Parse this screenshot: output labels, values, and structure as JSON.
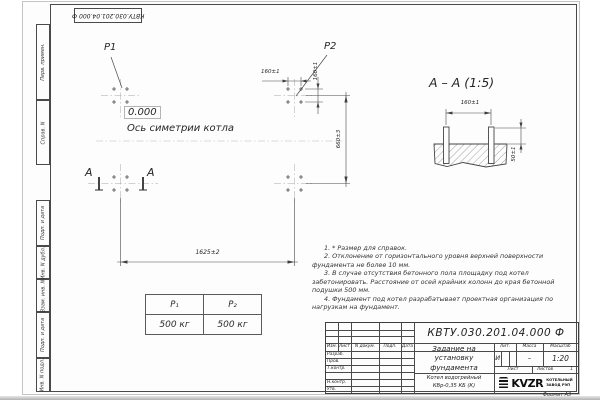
{
  "side_labels": [
    "Перв. примен.",
    "Справ. N",
    "Подп. и дата",
    "Инв. N дубл.",
    "Взам. инв. N",
    "Подп. и дата",
    "Инв. N подл."
  ],
  "plan": {
    "p1": "P1",
    "p2": "P2",
    "elevation": "0.000",
    "axis_label": "Ось симетрии котла",
    "section_letter_left": "А",
    "section_letter_right": "А",
    "dims": {
      "top_spacing": "160±1",
      "side_spacing": "160±1",
      "height": "660±3",
      "width": "1625±2"
    }
  },
  "section": {
    "title": "А – А (1:5)",
    "dims": {
      "bolt_spacing": "160±1",
      "protrusion": "50±1"
    }
  },
  "load_table": {
    "headers": [
      "Р₁",
      "Р₂"
    ],
    "values": [
      "500 кг",
      "500 кг"
    ]
  },
  "notes": [
    "1. * Размер для справок.",
    "2. Отклонение от горизонтального уровня верхней поверхности фундамента не более 10 мм.",
    "3. В случае отсутствия бетонного пола площадку под котел забетонировать. Расстояние от осей крайних колонн до края бетонной подушки 500 мм.",
    "4. Фундамент под котел разрабатывает проектная организация по нагрузкам на фундамент."
  ],
  "title_block": {
    "designation": "КВТУ.030.201.04.000  Ф",
    "title_lines": [
      "Задание на",
      "установку",
      "фундамента"
    ],
    "product_lines": [
      "Котел водогрейный",
      "КВр-0,35  КБ  (К)"
    ],
    "rev_headers": [
      "Изм.",
      "Лист",
      "N докум.",
      "Подп.",
      "Дата"
    ],
    "role_rows": [
      "Разраб.",
      "Пров.",
      "Т.контр.",
      "Н.контр.",
      "Утв."
    ],
    "lit_header": "Лит.",
    "mass_header": "Масса",
    "scale_header": "Масштаб",
    "lit_value": "И",
    "mass_value": "–",
    "scale_value": "1:20",
    "sheet_label": "Лист",
    "sheets_label": "Листов",
    "sheets_value": "1",
    "logo_text": "KVZR",
    "logo_caption_lines": [
      "КОТЕЛЬНЫЙ",
      "ЗАВОД РЭП"
    ],
    "format_label": "Формат А3"
  }
}
